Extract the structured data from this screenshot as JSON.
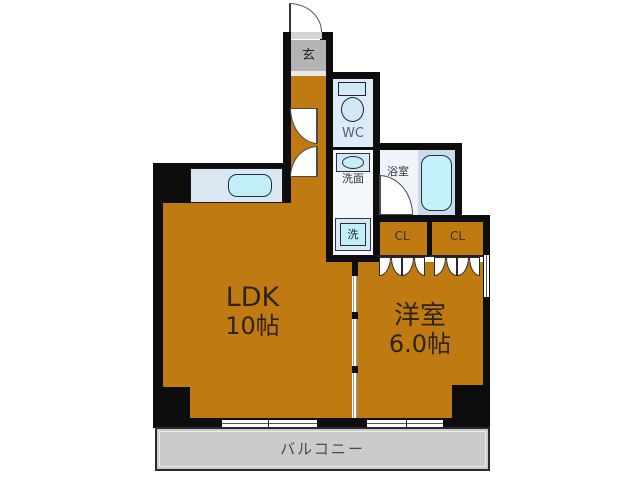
{
  "plan": {
    "genkan": {
      "label": "玄"
    },
    "wc": {
      "label": "WC"
    },
    "washroom": {
      "label": "洗面"
    },
    "laundry": {
      "label": "洗"
    },
    "bathroom": {
      "label": "浴室"
    },
    "closet1": {
      "label": "CL"
    },
    "closet2": {
      "label": "CL"
    },
    "ldk": {
      "label": "LDK",
      "size": "10帖"
    },
    "western_room": {
      "label": "洋室",
      "size": "6.0帖"
    },
    "balcony": {
      "label": "バルコニー"
    }
  },
  "colors": {
    "floor": "#c07a12",
    "wall": "#0d0d0d",
    "genkan": "#b3b3b3",
    "balcony": "#cbcbcb",
    "waterbg": "#dcebf7",
    "fixture": "#c2eef8",
    "counter": "#d9e7f3",
    "bathfloor": "#ccdbeb",
    "senmenbg": "#f3f7fb",
    "ink": "#2e2e2e",
    "bluetext": "#55606e"
  }
}
